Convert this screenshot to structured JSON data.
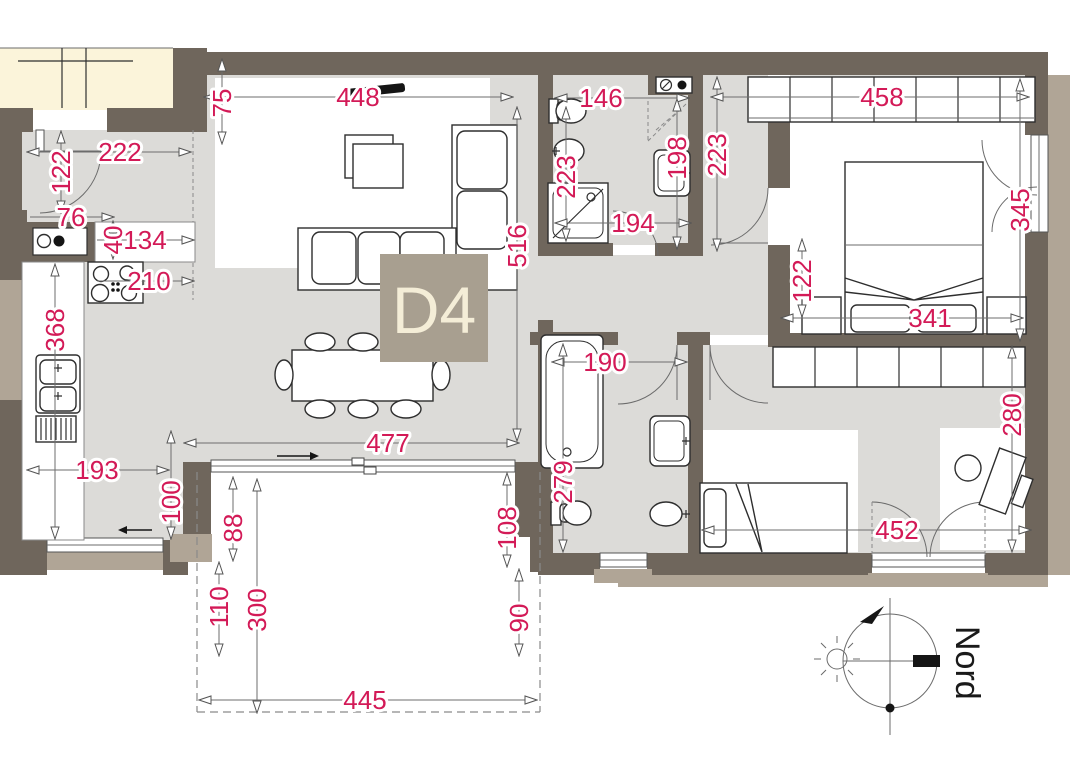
{
  "unit": {
    "label": "D4"
  },
  "compass": {
    "north_label": "Nord"
  },
  "colors": {
    "dimension_red": "#d31a57",
    "wall_dark": "#6f665c",
    "wall_light": "#b0a596",
    "floor_gray": "#dcdbd8",
    "adjacent_unit_cream": "#fbf4da",
    "unit_tag_background": "#a89f90",
    "unit_tag_text": "#f4edd7"
  },
  "dimensions_cm": {
    "living_top_width": "448",
    "top_offset": "75",
    "entry_width": "222",
    "entry_door": "122",
    "niche_width": "76",
    "counter_depth": "40",
    "counter_width": "134",
    "cooktop_width": "210",
    "kitchen_length": "368",
    "kitchen_width": "193",
    "kitchen_window_offset": "100",
    "living_width": "477",
    "living_length": "516",
    "bath1_width": "146",
    "bath1_length": "223",
    "bath1_sink_wall": "198",
    "corridor_length": "223",
    "bath1_bottom_width": "194",
    "wardrobe_width": "458",
    "bedroom1_window": "345",
    "bed_offset": "122",
    "bed_width": "341",
    "hall_door_width": "190",
    "bath2_length": "279",
    "bedroom2_length": "280",
    "bedroom2_width": "452",
    "balcony_offset_right": "108",
    "balcony_right_side": "90",
    "balcony_offset_left": "88",
    "balcony_left_side": "110",
    "balcony_depth": "300",
    "balcony_width": "445"
  }
}
